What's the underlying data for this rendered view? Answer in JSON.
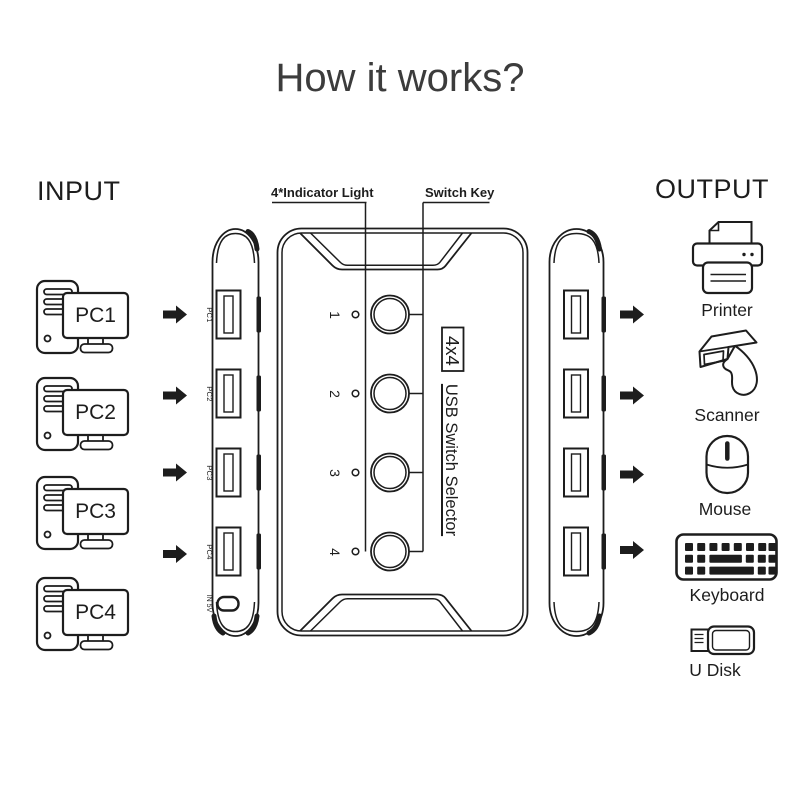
{
  "colors": {
    "background": "#ffffff",
    "ink": "#1d1d1d",
    "title_text": "#3c3c3c"
  },
  "title": "How it works?",
  "input": {
    "label": "INPUT",
    "pcs": [
      {
        "label": "PC1"
      },
      {
        "label": "PC2"
      },
      {
        "label": "PC3"
      },
      {
        "label": "PC4"
      }
    ]
  },
  "device": {
    "indicator_label": "4*Indicator Light",
    "switch_key_label": "Switch Key",
    "model": "4x4",
    "product_name": "USB Switch Selector",
    "channels": [
      "1",
      "2",
      "3",
      "4"
    ],
    "input_ports": [
      "PC1",
      "PC2",
      "PC3",
      "PC4"
    ],
    "power_port_label": "IN 5V"
  },
  "output": {
    "label": "OUTPUT",
    "devices": [
      {
        "name": "Printer"
      },
      {
        "name": "Scanner"
      },
      {
        "name": "Mouse"
      },
      {
        "name": "Keyboard"
      },
      {
        "name": "U Disk"
      }
    ]
  }
}
